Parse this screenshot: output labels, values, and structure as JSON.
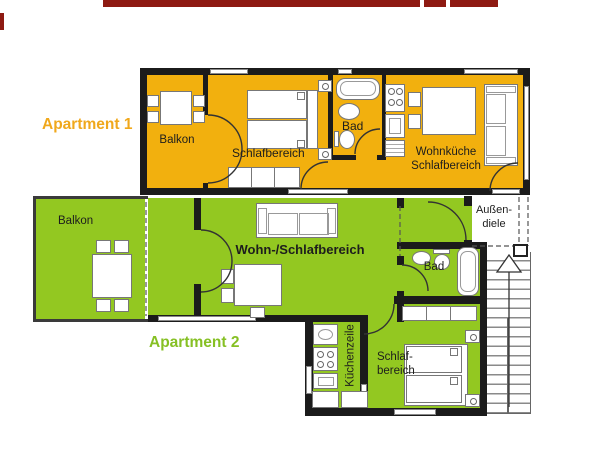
{
  "plan": {
    "apartment1": {
      "label": "Apartment 1",
      "rooms": {
        "balkon": "Balkon",
        "schlafbereich": "Schlafbereich",
        "bad": "Bad",
        "wohnkueche_line1": "Wohnküche",
        "wohnkueche_line2": "Schlafbereich"
      }
    },
    "apartment2": {
      "label": "Apartment 2",
      "rooms": {
        "balkon": "Balkon",
        "wohn_schlafbereich": "Wohn-/Schlafbereich",
        "bad": "Bad",
        "kuechenzeile": "Küchenzeile",
        "schlaf_line1": "Schlaf-",
        "schlaf_line2": "bereich"
      }
    },
    "outdoor": {
      "aussendiele_line1": "Außen-",
      "aussendiele_line2": "diele"
    },
    "colors": {
      "apartment1_fill": "#f2b00e",
      "apartment1_text": "#f0a81c",
      "apartment2_fill": "#93c821",
      "apartment2_text": "#86c024",
      "title_bar_red": "#8e1a12",
      "wall": "#1b1b1b"
    }
  }
}
